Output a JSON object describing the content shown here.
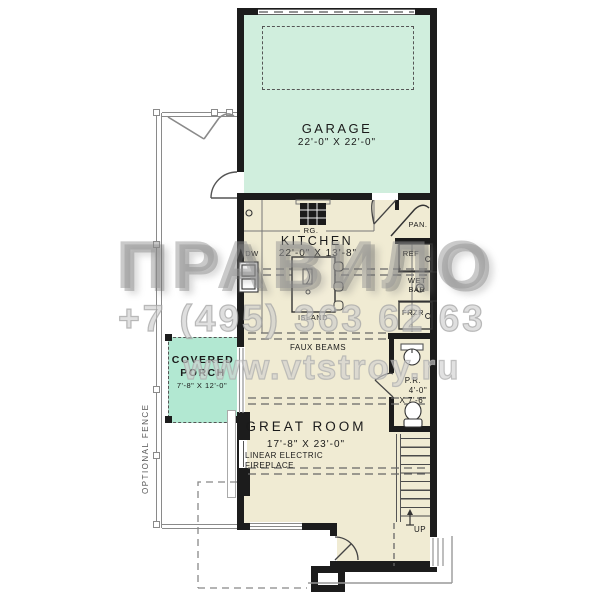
{
  "watermark": {
    "brand": "ПРАВИЛО",
    "phone": "+7 (495) 363 62 63",
    "website": "www.vtstroy.ru"
  },
  "rooms": {
    "garage": {
      "name": "GARAGE",
      "dims": "22'-0\" X 22'-0\""
    },
    "kitchen": {
      "name": "KITCHEN",
      "dims": "22'-0\" X 13'-8\""
    },
    "covered_porch": {
      "line1": "COVERED",
      "line2": "PORCH",
      "dims": "7'-8\" X 12'-0\""
    },
    "great_room": {
      "name": "GREAT ROOM",
      "dims": "17'-8\" X 23'-0\""
    },
    "powder_room": {
      "name": "P.R.",
      "dims1": "4'-0\"",
      "dims2": "X 7'-6\""
    }
  },
  "labels": {
    "range": "RG.",
    "dishwasher": "DW",
    "island": "ISLAND",
    "pantry": "PAN.",
    "refrigerator": "REF",
    "wet_bar1": "WET",
    "wet_bar2": "BAR",
    "freezer": "FRZR",
    "faux_beams": "FAUX BEAMS",
    "fireplace1": "LINEAR ELECTRIC",
    "fireplace2": "FIREPLACE",
    "up": "UP",
    "optional_fence": "OPTIONAL FENCE"
  },
  "colors": {
    "wall": "#1c1c1c",
    "garage_fill": "#d0eedd",
    "porch_fill": "#b2e8d2",
    "floor_fill": "#f0ebd3",
    "fence_gray": "#8a8a8a"
  }
}
